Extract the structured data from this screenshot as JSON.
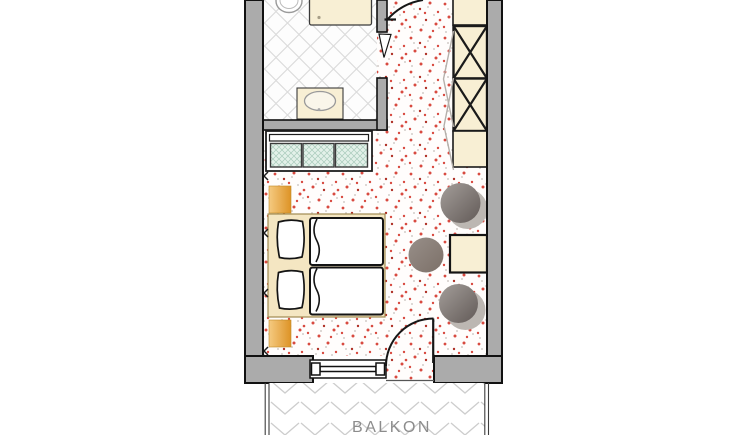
{
  "floorplan": {
    "balcony": {
      "label": "BALKON"
    },
    "palette": {
      "wall_fill": "#ababab",
      "wall_outline": "#111111",
      "furniture_beige": "#f8efd4",
      "bed_platform_beige": "#f4e6c2",
      "wood_orange_light": "#f5ca81",
      "wood_orange_dark": "#dd9326",
      "carpet_speckle_red": "#d84a40",
      "bathroom_tile_line": "#dcdcdc",
      "balcony_tile_line": "#cdcdcd",
      "glass_teal": "#e3f1e9",
      "glass_teal_line": "#a9cbbb",
      "chair_gray_light": "#a49e9a",
      "chair_gray_dark": "#625a57",
      "chair_shadow_gray": "#bcb7b2",
      "label_gray": "#8c8c8c"
    }
  }
}
